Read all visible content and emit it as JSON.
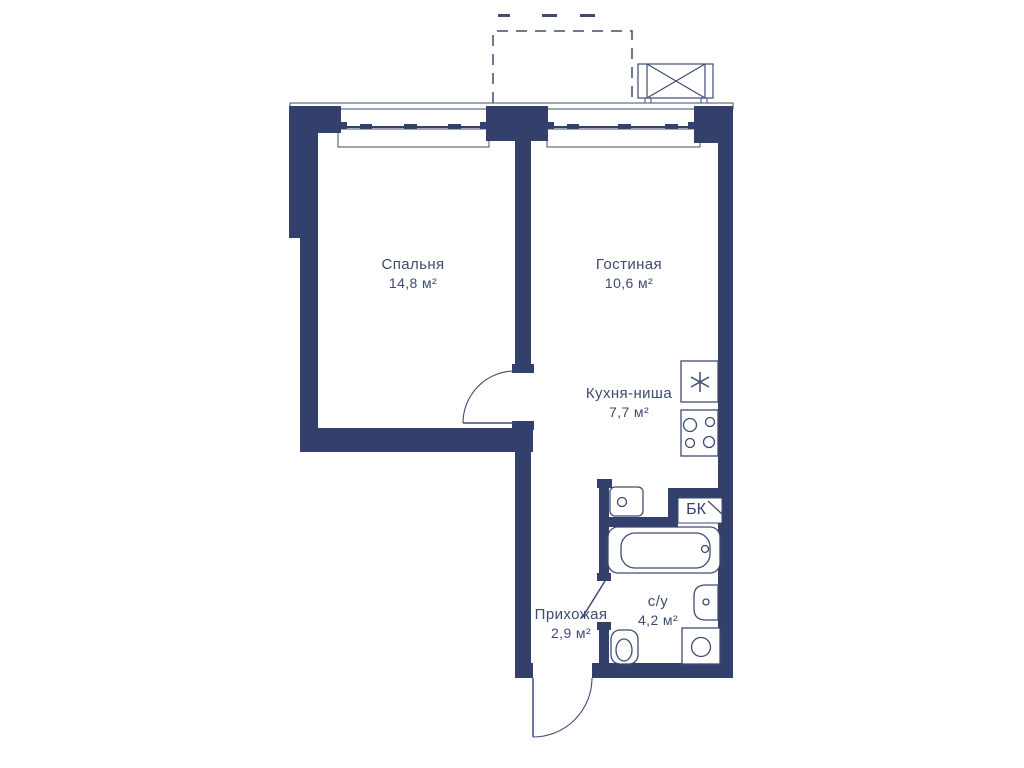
{
  "plan": {
    "rooms": [
      {
        "name": "Спальня",
        "area": "14,8 м²"
      },
      {
        "name": "Гостиная",
        "area": "10,6 м²"
      },
      {
        "name": "Кухня-ниша",
        "area": "7,7 м²"
      },
      {
        "name": "Прихожая",
        "area": "2,9 м²"
      },
      {
        "name": "с/у",
        "area": "4,2 м²"
      }
    ],
    "vent_shaft_label": "БК",
    "fixtures": [
      "kitchen-sink-icon",
      "stove-icon",
      "appliance-icon",
      "bathtub-icon",
      "washbasin-icon",
      "toilet-icon",
      "washing-machine-icon",
      "ac-basket-icon"
    ],
    "features": [
      "balcony-dashed-outline",
      "window",
      "window",
      "entrance-door-arc",
      "bedroom-door-arc",
      "bathroom-door-leaf"
    ],
    "colors": {
      "wall": "#33406b",
      "line": "#3e4c72",
      "text": "#3d4b70",
      "background": "#ffffff"
    }
  }
}
